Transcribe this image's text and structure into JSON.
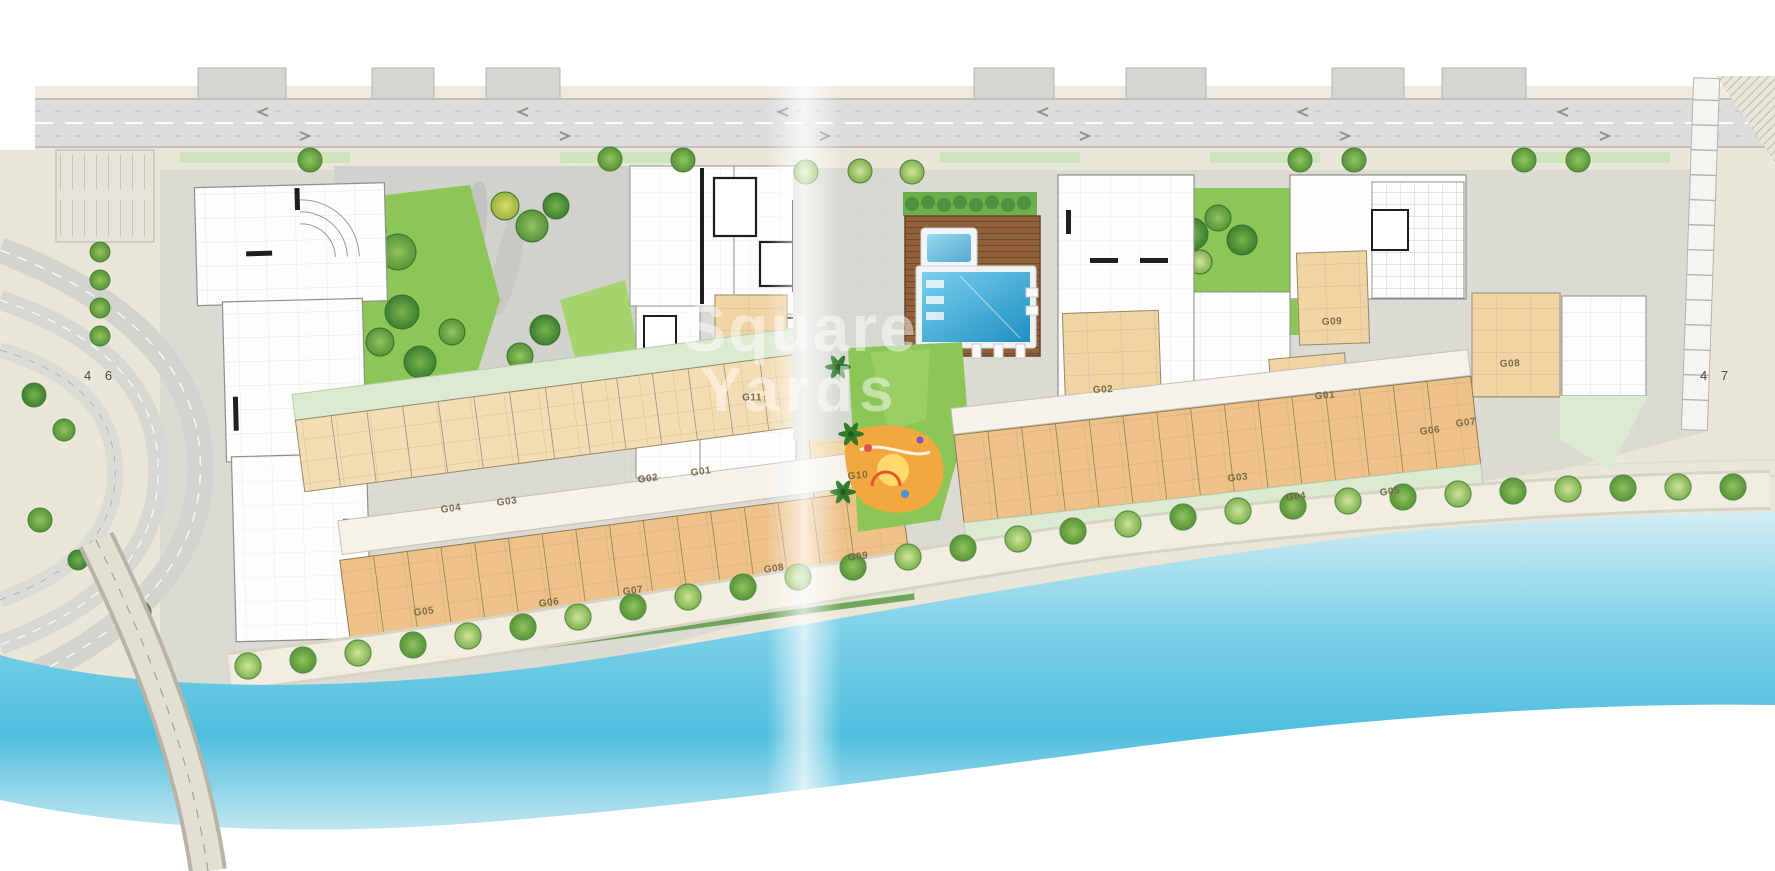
{
  "page": {
    "spread_left_number": "4 6",
    "spread_right_number": "4 7"
  },
  "watermark": {
    "line1": "Square",
    "line2": "Yards"
  },
  "plan": {
    "description_names": [
      "top-road",
      "left-interchange",
      "bridge",
      "west-building-cluster",
      "east-building-cluster",
      "west-garden",
      "east-garden",
      "pool-deck",
      "main-pool",
      "kids-pool",
      "playground",
      "lawn",
      "promenade",
      "beach",
      "water"
    ],
    "unit_labels": [
      {
        "text": "G11",
        "x": 752,
        "y": 398,
        "r": 0
      },
      {
        "text": "G10",
        "x": 858,
        "y": 476,
        "r": -5
      },
      {
        "text": "G01",
        "x": 701,
        "y": 472,
        "r": -8
      },
      {
        "text": "G02",
        "x": 648,
        "y": 479,
        "r": -8
      },
      {
        "text": "G03",
        "x": 507,
        "y": 502,
        "r": -8
      },
      {
        "text": "G04",
        "x": 451,
        "y": 509,
        "r": -8
      },
      {
        "text": "G05",
        "x": 424,
        "y": 612,
        "r": -8
      },
      {
        "text": "G06",
        "x": 549,
        "y": 603,
        "r": -8
      },
      {
        "text": "G07",
        "x": 633,
        "y": 591,
        "r": -8
      },
      {
        "text": "G08",
        "x": 774,
        "y": 569,
        "r": -8
      },
      {
        "text": "G09",
        "x": 858,
        "y": 557,
        "r": -8
      },
      {
        "text": "G02",
        "x": 1103,
        "y": 390,
        "r": -3
      },
      {
        "text": "G09",
        "x": 1332,
        "y": 322,
        "r": -3
      },
      {
        "text": "G01",
        "x": 1325,
        "y": 396,
        "r": -5
      },
      {
        "text": "G03",
        "x": 1238,
        "y": 478,
        "r": -7
      },
      {
        "text": "G04",
        "x": 1296,
        "y": 497,
        "r": -7
      },
      {
        "text": "G05",
        "x": 1390,
        "y": 492,
        "r": -7
      },
      {
        "text": "G06",
        "x": 1430,
        "y": 431,
        "r": -7
      },
      {
        "text": "G07",
        "x": 1466,
        "y": 423,
        "r": -7
      },
      {
        "text": "G08",
        "x": 1510,
        "y": 364,
        "r": -2
      }
    ]
  },
  "colors": {
    "page_bg": "#ffffff",
    "sand": "#eae6d8",
    "paver": "#dbdad3",
    "paver_dark": "#cfcfc9",
    "road": "#dedddb",
    "road_edge": "#b7b7b2",
    "lawn": "#8cc657",
    "lawn_light": "#a5d46c",
    "tree_dark": "#3f8a34",
    "tree_mid": "#63ab45",
    "tree_light": "#8ec85e",
    "tree_yellow": "#b9cf4b",
    "terrace": "#dcead2",
    "hedge": "#4c923c",
    "unit_tan": "#f3ddb4",
    "unit_orange": "#eec189",
    "unit_deep": "#f1d4a4",
    "wall": "#8f8f8a",
    "wall_dark": "#1e1e1e",
    "deck": "#8a5c36",
    "deck_line": "#724a2b",
    "pool_light": "#66c8e8",
    "pool_deep": "#2293c7",
    "water_light": "#cfeaf2",
    "water_mid": "#62c8e2",
    "water_pale": "#bfe6ef",
    "playground": "#f2a83e",
    "playground_yellow": "#ffd96b",
    "label_text": "#7a6a4c",
    "page_number": "#4a4a48",
    "watermark": "rgba(255,255,255,0.48)"
  }
}
